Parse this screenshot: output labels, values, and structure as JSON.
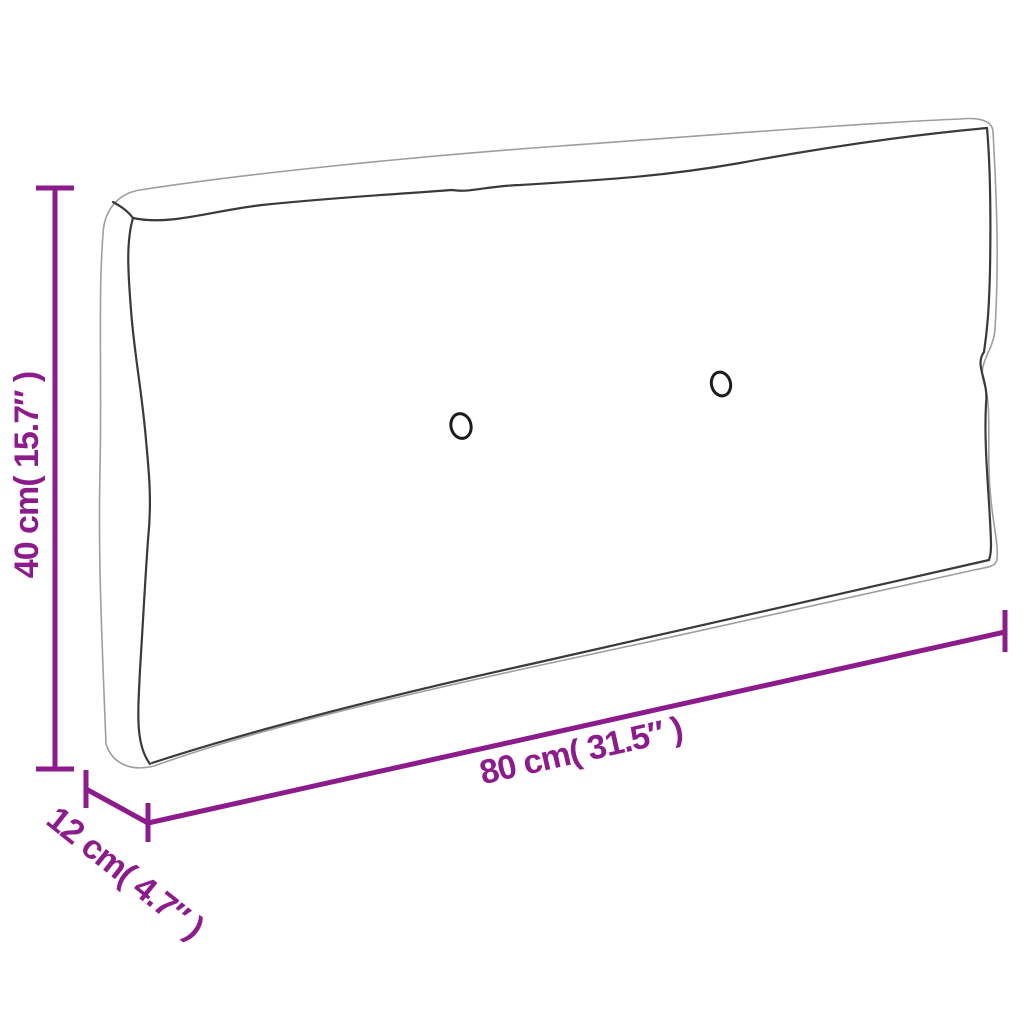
{
  "diagram": {
    "type": "product-dimension-diagram",
    "subject": "pallet-cushion-outline",
    "dimensions": {
      "height": {
        "label": "40 cm( 15.7″ )",
        "value_cm": 40,
        "value_inch": 15.7
      },
      "depth": {
        "label": "12 cm( 4.7″ )",
        "value_cm": 12,
        "value_inch": 4.7
      },
      "width": {
        "label": "80 cm( 31.5″ )",
        "value_cm": 80,
        "value_inch": 31.5
      }
    },
    "colors": {
      "dimension_accent": "#8C1C8C",
      "outline": "#9E9E9E",
      "seam": "#3A3A3A",
      "button": "#1C1C1C",
      "background": "#FFFFFF"
    },
    "elements": {
      "buttons_count": 2
    }
  }
}
